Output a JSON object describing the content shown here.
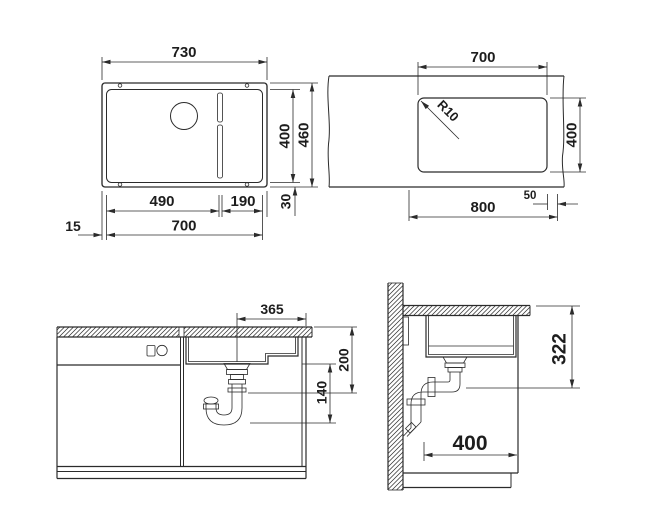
{
  "drawing": {
    "kind": "sink-installation-technical-drawing",
    "colors": {
      "line": "#2b2b2b",
      "background": "#ffffff",
      "text": "#1d1d1d"
    }
  },
  "views": {
    "top": {
      "title": "sink-top-view",
      "overall_width": "730",
      "inner_width": "700",
      "drain_left": "490",
      "rail_right": "190",
      "rim_left": "15",
      "inner_depth": "400",
      "overall_depth": "460",
      "rim_bottom": "30"
    },
    "cutout": {
      "title": "countertop-cutout-view",
      "width": "700",
      "corner_radius": "R10",
      "depth": "400",
      "side_clearance": "50",
      "min_cabinet_width": "800"
    },
    "front": {
      "title": "cabinet-front-view",
      "drain_offset": "365",
      "upper_height": "200",
      "drain_height": "140"
    },
    "side": {
      "title": "cabinet-side-view",
      "mount_height": "322",
      "wall_clearance": "400"
    }
  }
}
